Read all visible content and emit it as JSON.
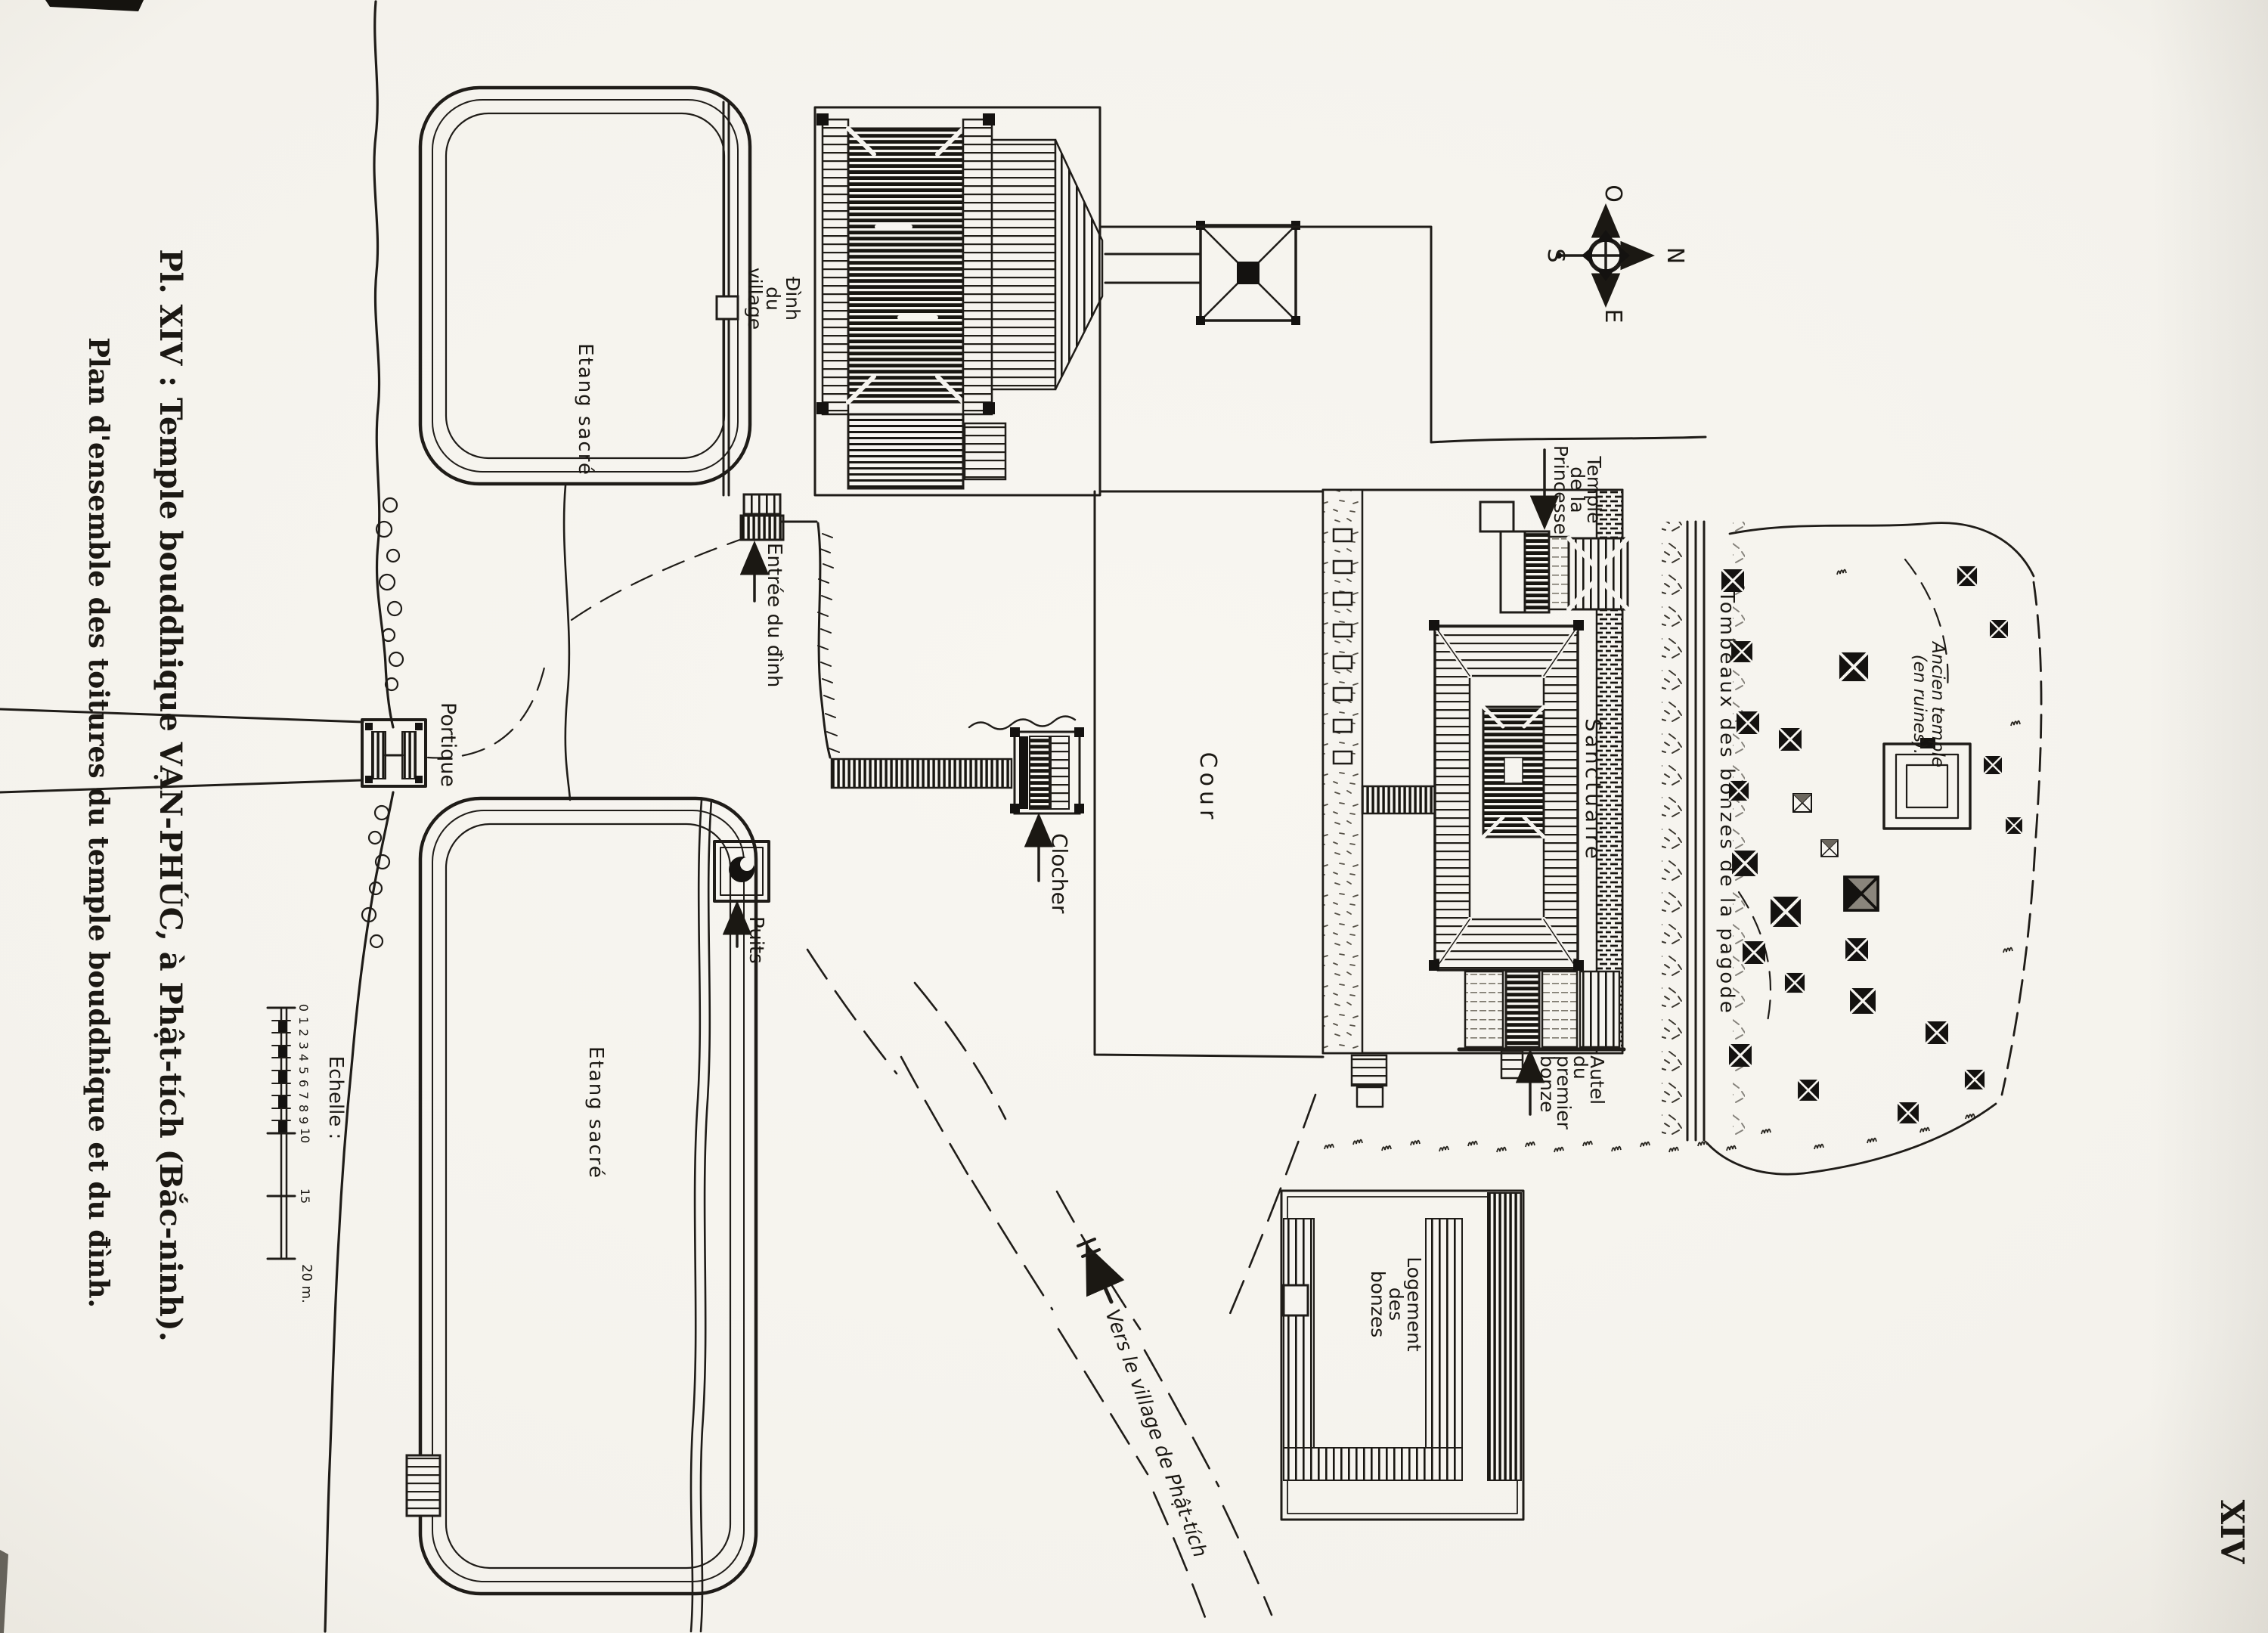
{
  "plate": {
    "title1": "Pl. XIV : Temple bouddhique VẠN-PHÚC, à Phật-tích (Bắc-ninh).",
    "title2": "Plan d'ensemble des toitures du temple bouddhique et du đình.",
    "number": "XIV"
  },
  "compass": {
    "o": "O",
    "n": "N",
    "s": "S",
    "e": "E"
  },
  "scale": {
    "label": "Echelle :",
    "ticks": [
      "0",
      "1",
      "2",
      "3",
      "4",
      "5",
      "6",
      "7",
      "8",
      "9",
      "10",
      "15"
    ],
    "end": "20 m."
  },
  "labels": {
    "pond_top": "Etang sacré",
    "pond_bottom": "Etang sacré",
    "dinh": [
      "Đình",
      "du",
      "village"
    ],
    "entree": "Entrée du đình",
    "portique": "Portique",
    "puits": "Puits",
    "clocher": "Clocher",
    "cour": "Cour",
    "sanctuaire": "Sanctuaire",
    "princesse": [
      "Temple",
      "de la",
      "Princesse"
    ],
    "tombeaux": "Tombeaux des bonzes de la pagode",
    "ancien": [
      "Ancien temple",
      "(en ruines)."
    ],
    "autel": [
      "Autel",
      "du",
      "premier",
      "bonze"
    ],
    "logement": [
      "Logement",
      "des",
      "bonzes"
    ],
    "vers": "Vers le village de Phật-tích"
  }
}
